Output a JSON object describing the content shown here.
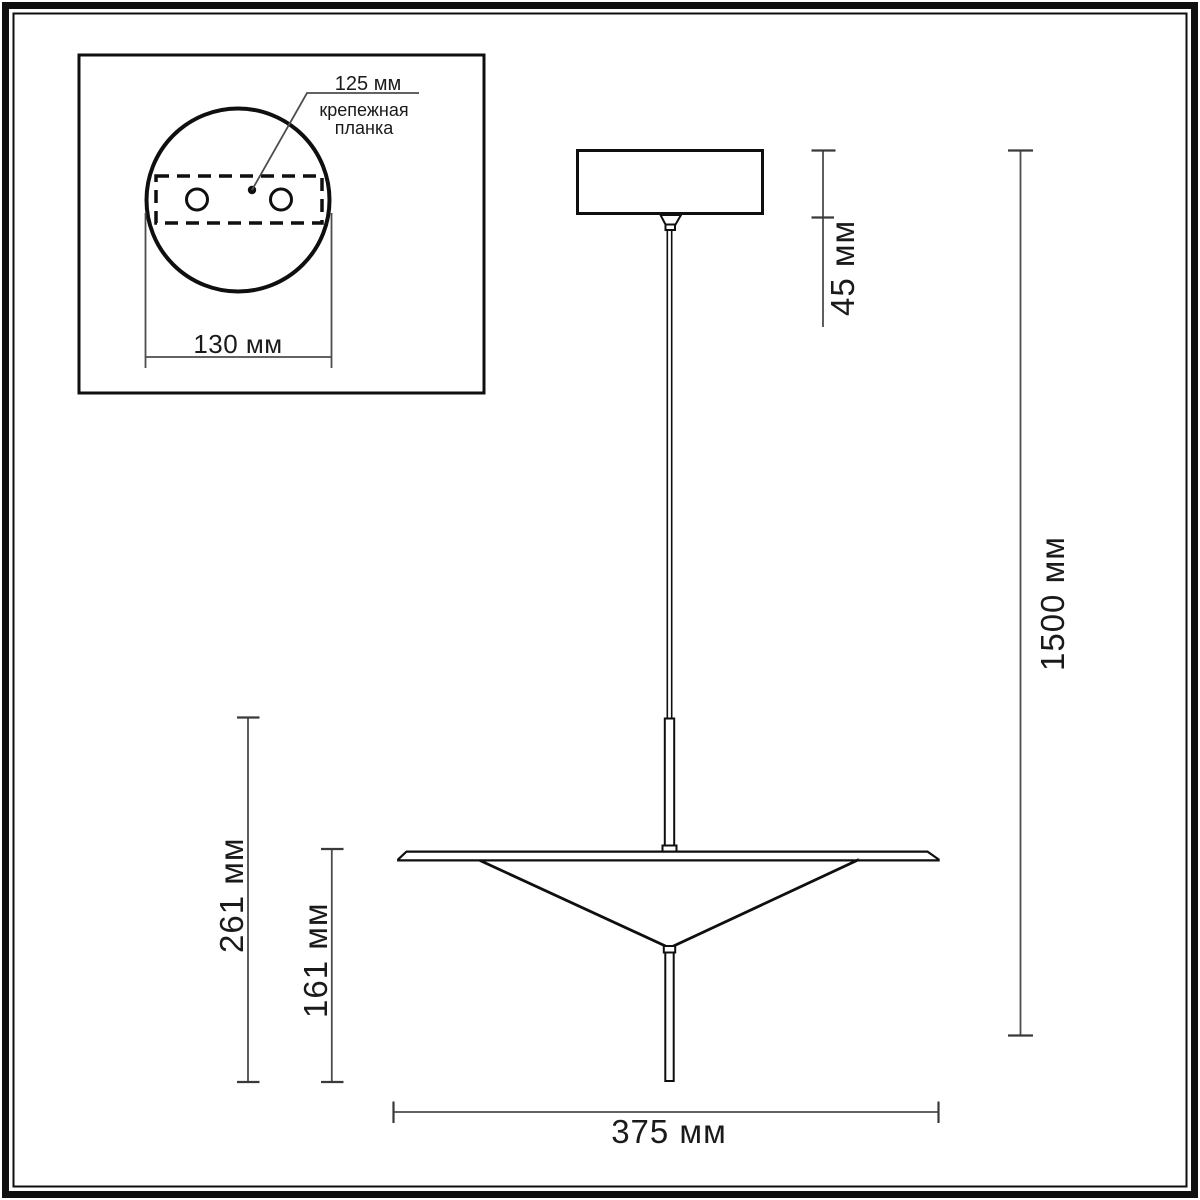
{
  "figure": {
    "kind": "pendant-lamp-dimension-drawing",
    "background_color": "#ffffff",
    "line_color": "#0f0f0f",
    "dimension_line_color": "#4d4d4d",
    "text_color": "#1a1a1a"
  },
  "inset": {
    "labels": {
      "plate_width": "125 мм",
      "plate_line1": "крепежная",
      "plate_line2": "планка",
      "base_width": "130 мм"
    }
  },
  "dims": {
    "canopy_height": "45 мм",
    "total_height": "1500 мм",
    "stem_shade_height": "261 мм",
    "shade_height": "161 мм",
    "shade_width": "375 мм"
  }
}
